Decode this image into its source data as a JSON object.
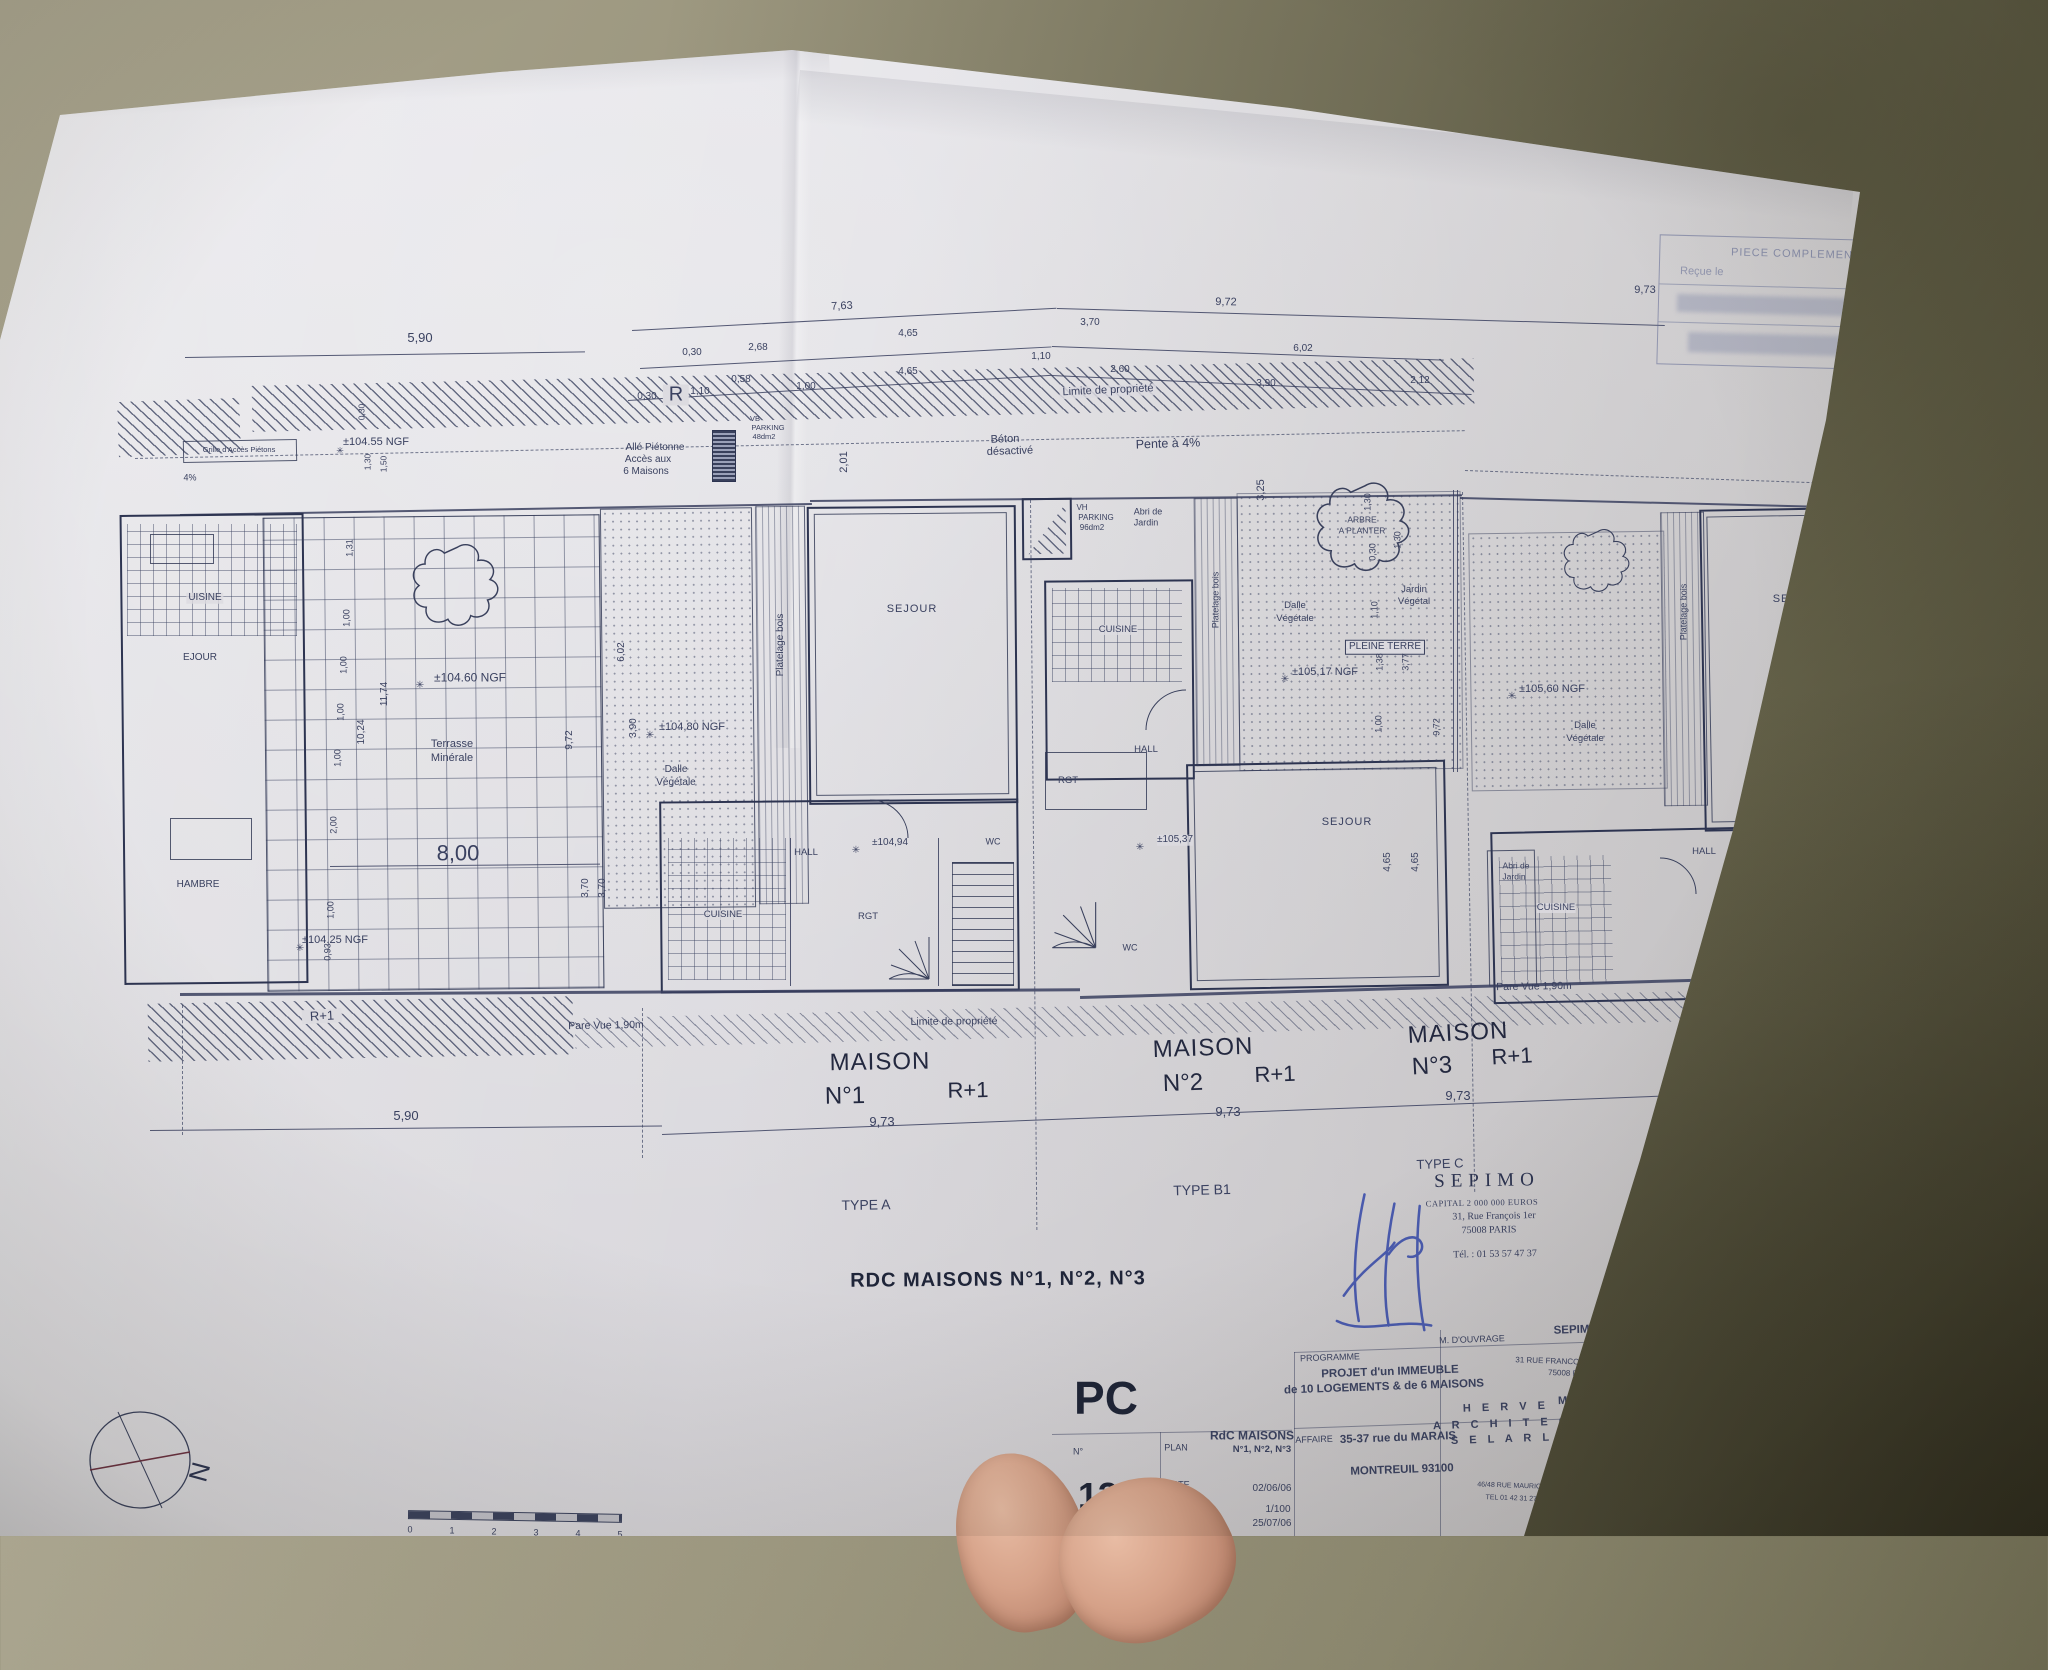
{
  "labels": {
    "north": "N",
    "title": "RDC MAISONS N°1, N°2, N°3",
    "type_a": "TYPE A",
    "type_b1": "TYPE B1",
    "type_c": "TYPE C",
    "maison": "MAISON",
    "n1": "N°1",
    "n2": "N°2",
    "n3": "N°3",
    "r1": "R+1"
  },
  "dims": {
    "top_590": "5,90",
    "row1": [
      "7,63",
      "9,72",
      "9,73"
    ],
    "row2": [
      "0,30",
      "2,68",
      "4,65",
      "3,70",
      "6,02"
    ],
    "row3": [
      "0,30",
      "1,10",
      "0,58",
      "1,00",
      "4,65",
      "1,10",
      "2,60",
      "3,90",
      "2,12"
    ],
    "chain": [
      "1,31",
      "1,00",
      "1,00",
      "1,00",
      "1,00",
      "2,00",
      "1,00",
      "0,93"
    ],
    "d1024": "10,24",
    "d1174": "11,74",
    "d972a": "9,72",
    "d602": "6,02",
    "d390": "3,90",
    "d370a": "3,70",
    "d370b": "3,70",
    "d201": "2,01",
    "d325": "3,25",
    "d800": "8,00",
    "d030": "0,30",
    "d130": "1,30",
    "d150": "1,50",
    "m2chain": [
      "1,30",
      "0,30",
      "1,30",
      "1,10",
      "1,38",
      "3,77",
      "1,00",
      "9,72"
    ],
    "m2v": [
      "4,65",
      "4,65"
    ],
    "bottom_590": "5,90",
    "bottom_973": [
      "9,73",
      "9,73",
      "9,73"
    ]
  },
  "road": {
    "r": "R",
    "limite": "Limite de propriété",
    "limite_b": "Limite de propriété",
    "grille": "Grille d'Accès Piétons",
    "pct4": "4%",
    "ngf_10455": "±104.55 NGF",
    "vb": [
      "VB",
      "PARKING",
      "48dm2"
    ],
    "alle": [
      "Allé Piétonne",
      "Accès aux",
      "6 Maisons"
    ],
    "beton": [
      "Béton",
      "désactivé"
    ],
    "pente": "Pente à 4%",
    "pare1": "Pare Vue 1,90m",
    "pare2": "Pare Vue 1,90m",
    "rplus1": "R+1"
  },
  "m0": {
    "cuisine": "UISINE",
    "sejour": "EJOUR",
    "chambre": "HAMBRE"
  },
  "m1": {
    "sejour": "SEJOUR",
    "hall": "HALL",
    "rgt": "RGT",
    "wc": "WC",
    "cuisine": "CUISINE",
    "ngf_a": "±104.60 NGF",
    "ngf_b": "±104.25 NGF",
    "ngf_c": "±104,94",
    "ngf_d": "±104,80 NGF",
    "terrasse": [
      "Terrasse",
      "Minérale"
    ],
    "dalle": [
      "Dalle",
      "Végétale"
    ],
    "platelage": "Platelage bois"
  },
  "m2": {
    "sejour": "SEJOUR",
    "hall": "HALL",
    "rgt": "RGT",
    "wc": "WC",
    "cuisine": "CUISINE",
    "ngf_a": "±105,17 NGF",
    "ngf_b": "±105,37",
    "pleine": "PLEINE TERRE",
    "arbre": [
      "ARBRE",
      "A PLANTER"
    ],
    "jardin": [
      "Jardin",
      "Végétal"
    ],
    "dalle": [
      "Dalle",
      "Végétale"
    ],
    "platelage": "Platelage bois",
    "vh": [
      "VH",
      "PARKING",
      "96dm2"
    ],
    "abri": [
      "Abri de",
      "Jardin"
    ]
  },
  "m3": {
    "sejour": "SEJOUR",
    "hall": "HALL",
    "rgt": "RGT",
    "wc": "WC",
    "cuisine": "CUISINE",
    "ngf_a": "±105,60 NGF",
    "ngf_b": "±105,80",
    "dalle": [
      "Dalle",
      "Végétale"
    ],
    "platelage": "Platelage bois",
    "abri": [
      "Abri de",
      "Jardin"
    ]
  },
  "stamp": {
    "l1": "PIECE COMPLEMENTAIRE",
    "l2": "Reçue le"
  },
  "sepimo": {
    "name": "SEPIMO",
    "capital": "CAPITAL 2 000 000 EUROS",
    "addr1": "31, Rue François 1er",
    "addr2": "75008 PARIS",
    "tel": "Tél. : 01 53 57 47 37"
  },
  "titleblock": {
    "pc": "PC",
    "no_label": "N°",
    "no": "13",
    "plan_label": "PLAN",
    "plan1": "RdC MAISONS",
    "plan2": "N°1, N°2, N°3",
    "date_label": "DATE",
    "date": "02/06/06",
    "echelle_label": "ECHELLE",
    "echelle": "1/100",
    "date2": "25/07/06",
    "programme_label": "PROGRAMME",
    "prog1": "PROJET d'un IMMEUBLE",
    "prog2": "de 10 LOGEMENTS & de 6 MAISONS",
    "mo_label": "M. D'OUVRAGE",
    "mo_name": "SEPIMO",
    "mo_addr1": "31 RUE FRANCOIS 1ER",
    "mo_addr2": "75008 PARIS",
    "affaire_label": "AFFAIRE",
    "aff1": "35-37 rue du MARAIS",
    "aff2": "MONTREUIL 93100",
    "arch1": "H E R V E",
    "arch1b": "M O R A N D",
    "arch2": "A R C H I T E C T E",
    "arch3": "S E L A R L",
    "arch_addr": "46/48 RUE MAURICE ARNOUX 92120 MONTROUGE",
    "arch_tel": "TEL 01 42 31 27 15   FAX 01 42 31 28 15"
  },
  "scalebar": {
    "ticks": [
      "0",
      "1",
      "2",
      "3",
      "4",
      "5"
    ]
  },
  "icons": {
    "ngf_marker": "✳"
  }
}
